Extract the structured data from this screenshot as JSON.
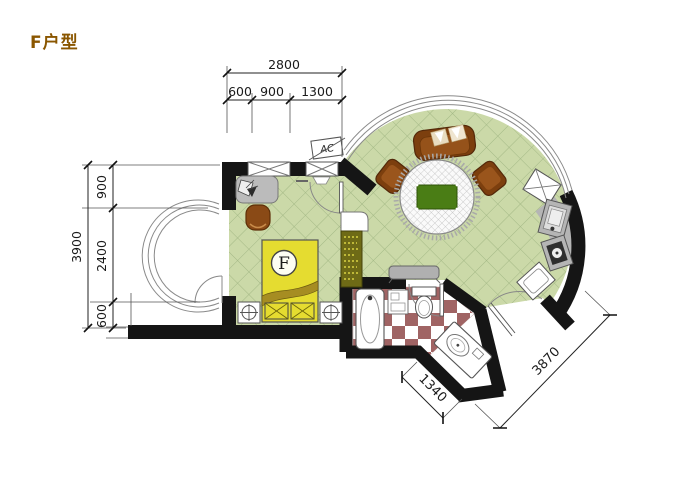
{
  "title": "F户型",
  "plan": {
    "labels": {
      "ac_unit": "AC",
      "bed_marker": "F"
    },
    "dimensions": {
      "top_total": "2800",
      "top_segments": [
        "600",
        "900",
        "1300"
      ],
      "left_total": "3900",
      "left_segments": [
        "900",
        "2400",
        "600"
      ],
      "entry_width": "1340",
      "facade_width": "3870"
    },
    "colors": {
      "wall": "#151515",
      "floor_green": "#cbd9a8",
      "floor_grid": "#a3b885",
      "checker_maroon": "#a06464",
      "bed_yellow": "#e5dc30",
      "furniture_brown": "#7c3f0e",
      "counter_gray": "#b5b5b5",
      "table_green": "#4a7d15",
      "title_brown": "#8a5600"
    }
  }
}
